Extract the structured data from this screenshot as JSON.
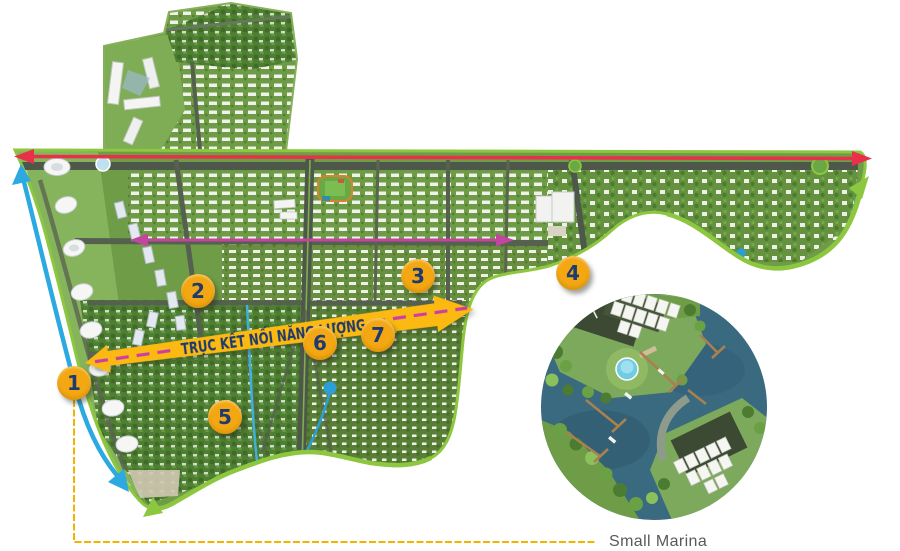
{
  "map": {
    "banner": {
      "label": "TRỤC KẾT NỐI NĂNG LƯỢNG"
    },
    "markers": [
      {
        "label": "1"
      },
      {
        "label": "2"
      },
      {
        "label": "3"
      },
      {
        "label": "4"
      },
      {
        "label": "5"
      },
      {
        "label": "6"
      },
      {
        "label": "7"
      }
    ],
    "inset": {
      "label": "Small Marina"
    },
    "colors": {
      "marker_yellow": "#F3A712",
      "banner_yellow": "#FBB911",
      "number_navy": "#1E3A6E",
      "axis_red": "#E8304A",
      "axis_magenta": "#C2459E",
      "axis_blue": "#2BA9E0",
      "boundary_green": "#8DC63F",
      "callout_yellow": "#F5B301",
      "label_gray": "#58595B"
    }
  }
}
